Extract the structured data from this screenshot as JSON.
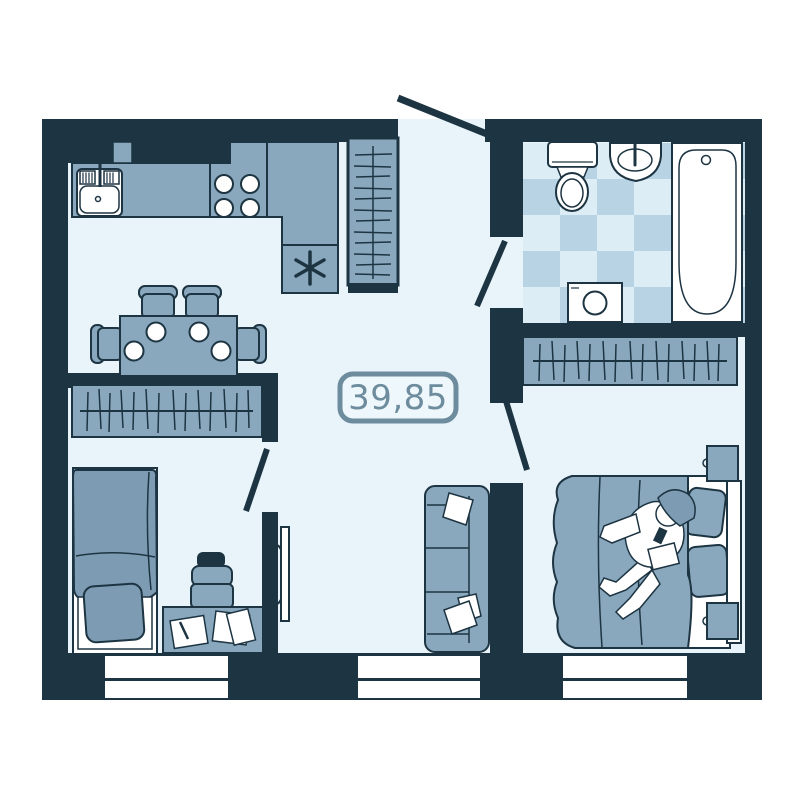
{
  "floor_plan": {
    "area_label": "39,85",
    "colors": {
      "wall": "#1d3442",
      "floor": "#e8f4fa",
      "furniture": "#8aa8bd",
      "furniture_shade": "#7d9cb3",
      "tile_light": "#ddedf6",
      "tile_medium": "#b7d3e4",
      "fixture_white": "#ffffff",
      "area_label_color": "#6d8c9d",
      "background": "#ffffff"
    },
    "elements": {
      "kitchen": [
        "kitchen-sink",
        "faucet",
        "stove-four-burners",
        "l-shaped-counter",
        "appliance-asterisk-mark",
        "tall-hatched-wardrobe",
        "vent-block"
      ],
      "dining": [
        "dining-table",
        "four-chairs",
        "four-plates"
      ],
      "bathroom": [
        "toilet",
        "wash-basin",
        "bathtub",
        "washing-machine",
        "checkered-tile-floor"
      ],
      "bedroom": [
        "hatched-wardrobe",
        "double-bed",
        "two-pillows",
        "person-lying-on-bed",
        "two-nightstands",
        "headboard"
      ],
      "kids_room": [
        "hatched-wardrobe",
        "single-bed",
        "pillow",
        "desk",
        "desk-chair",
        "papers-and-pen"
      ],
      "living_hall": [
        "wall-mounted-tv",
        "three-seat-sofa",
        "sofa-pillows",
        "area-label-badge"
      ],
      "windows": 3,
      "door_openings": 4
    }
  }
}
